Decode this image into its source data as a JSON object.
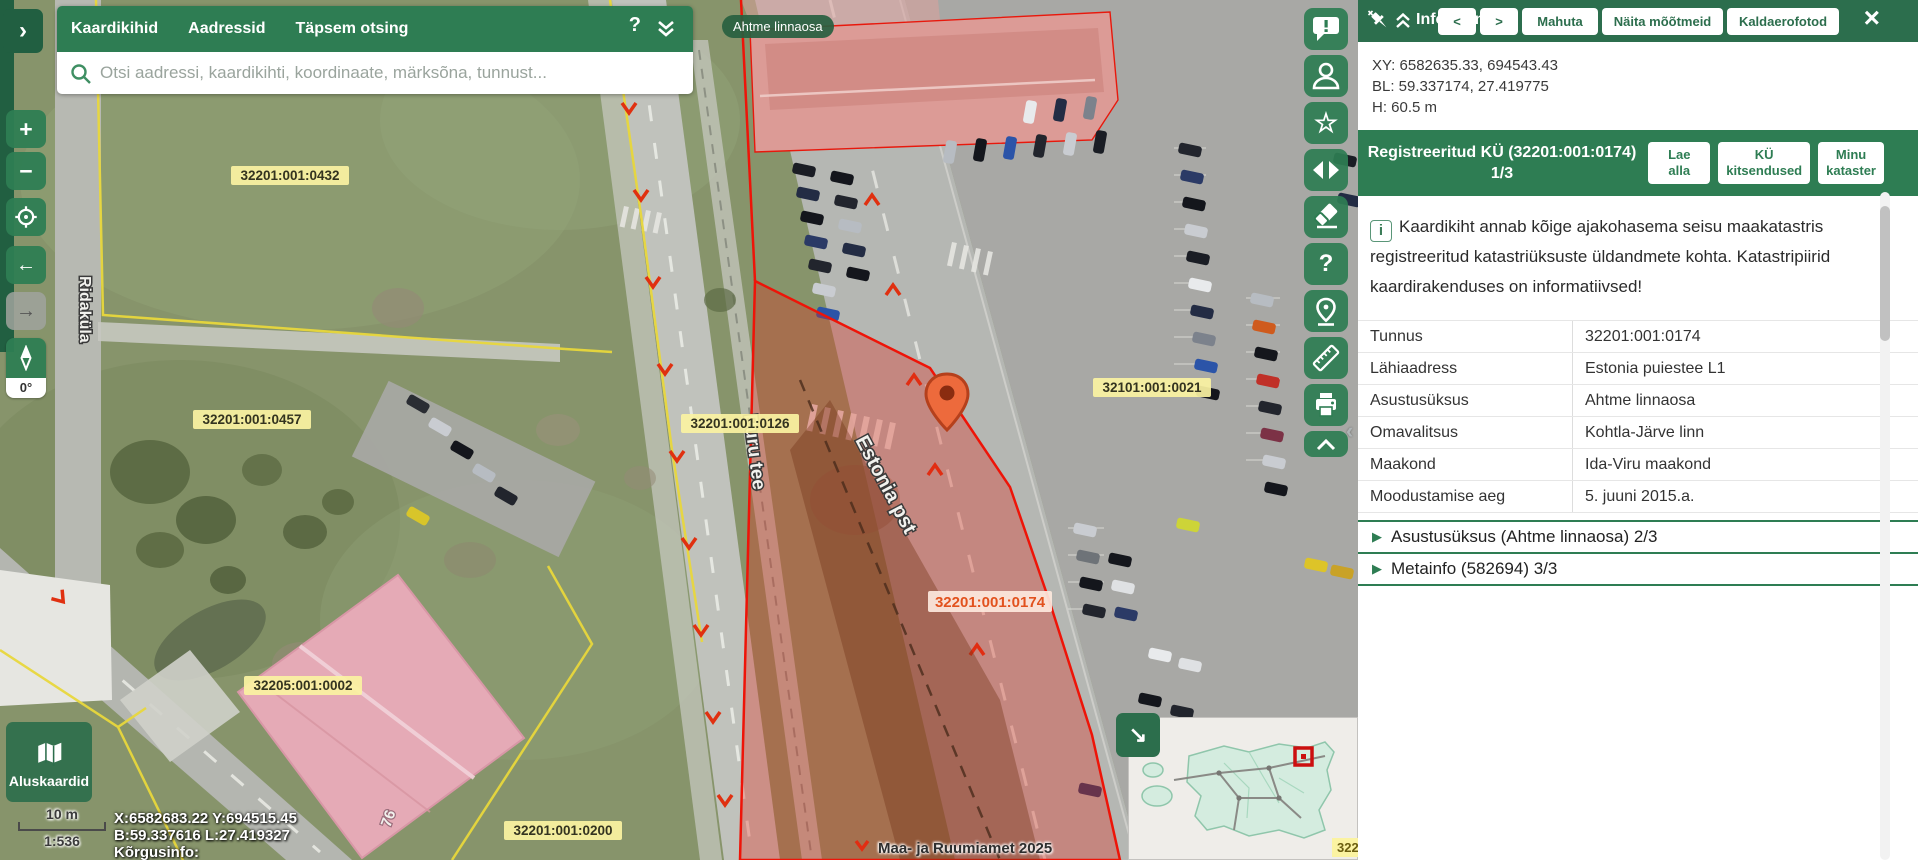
{
  "app": {
    "region_pill": "Ahtme linnaosa",
    "attribution": "Maa- ja Ruumiamet 2025"
  },
  "search_panel": {
    "tabs": [
      "Kaardikihid",
      "Aadressid",
      "Täpsem otsing"
    ],
    "placeholder": "Otsi aadressi, kaardikihti, koordinaate, märksõna, tunnust...",
    "help_glyph": "?"
  },
  "map_controls": {
    "zoom_in": "+",
    "zoom_out": "−",
    "back": "←",
    "forward": "→",
    "rotation": "0°",
    "sidebar_expand": "›",
    "panel_collapse": "‹"
  },
  "basemap": {
    "label": "Aluskaardid"
  },
  "scale": {
    "distance": "10 m",
    "ratio": "1:536"
  },
  "status": {
    "line1": "X:6582683.22 Y:694515.45",
    "line2": "B:59.337616 L:27.419327",
    "line3": "Kõrgusinfo:"
  },
  "map_labels": {
    "parcel_0432": "32201:001:0432",
    "parcel_0457": "32201:001:0457",
    "parcel_0126": "32201:001:0126",
    "parcel_0021": "32101:001:0021",
    "parcel_0002": "32205:001:0002",
    "parcel_0200": "32201:001:0200",
    "selected_parcel": "32201:001:0174",
    "street_ridakula": "Ridaküla",
    "street_puru": "Puru tee",
    "street_estonia": "Estonia pst",
    "building_number": "76",
    "corner_partial": "322"
  },
  "right_toolbar": {
    "icons": [
      "feedback",
      "user",
      "bookmarks",
      "compare",
      "eraser",
      "help",
      "add-marker",
      "measure",
      "print",
      "collapse"
    ],
    "help_glyph": "?",
    "star_glyph": "☆"
  },
  "info_panel": {
    "title": "Infopäring",
    "nav": {
      "prev": "<",
      "next": ">"
    },
    "header_buttons": [
      "Mahuta",
      "Näita mõõtmeid",
      "Kaldaerofotod"
    ],
    "close_glyph": "×",
    "coords": {
      "xy": "XY: 6582635.33, 694543.43",
      "bl": "BL: 59.337174, 27.419775",
      "h": "H: 60.5 m"
    },
    "section": {
      "title": "Registreeritud KÜ (32201:001:0174) 1/3",
      "buttons": [
        "Lae\nalla",
        "KÜ\nkitsendused",
        "Minu\nkataster"
      ]
    },
    "notice_icon": "i",
    "notice": "Kaardikiht annab kõige ajakohasema seisu maakatastris registreeritud katastriüksuste üldandmete kohta. Katastripiirid kaardirakenduses on informatiivsed!",
    "table": [
      {
        "label": "Tunnus",
        "value": "32201:001:0174"
      },
      {
        "label": "Lähiaadress",
        "value": "Estonia puiestee L1"
      },
      {
        "label": "Asustusüksus",
        "value": "Ahtme linnaosa"
      },
      {
        "label": "Omavalitsus",
        "value": "Kohtla-Järve linn"
      },
      {
        "label": "Maakond",
        "value": "Ida-Viru maakond"
      },
      {
        "label": "Moodustamise aeg",
        "value": "5. juuni 2015.a."
      }
    ],
    "accordions": [
      {
        "expander": "▶",
        "label": "Asustusüksus (Ahtme linnaosa) 2/3"
      },
      {
        "expander": "▶",
        "label": "Metainfo (582694) 3/3"
      }
    ]
  },
  "colors": {
    "brand_green": "#2e7d53",
    "dark_green": "#215f41",
    "panel_header_green": "#2c6e4d",
    "accent_red": "#ee1408",
    "label_yellow": "#fbf3a2",
    "selected_label_text": "#e2521e"
  }
}
